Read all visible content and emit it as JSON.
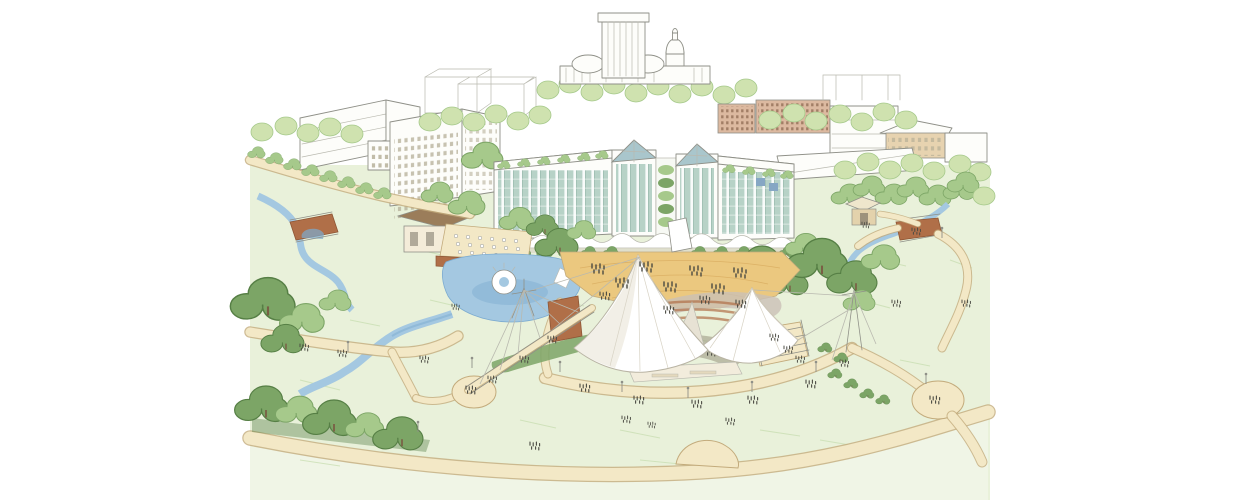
{
  "canvas": {
    "width": "1235",
    "height": "500",
    "viewbox": "0 0 1235 500",
    "background": "#ffffff"
  },
  "palette": {
    "background": "#ffffff",
    "line-gray": "#8f9088",
    "line-soft": "#b9b9af",
    "building-white": "#fdfdfa",
    "building-shade": "#ebebe2",
    "window-tan": "#d9c189",
    "brick-light": "#dcb9a0",
    "glass-teal": "#b7d2c7",
    "glass-deep": "#8fb3a6",
    "glass-blue": "#a9c6cc",
    "tree-light": "#cfe2af",
    "tree-mid": "#a6c98b",
    "tree-dark": "#7ca566",
    "tree-deep": "#567f45",
    "lawn": "#e9f1da",
    "lawn-pale": "#f0f5e6",
    "lawn-stroke": "#c6dcae",
    "path": "#f3e8c6",
    "path-edge": "#c3ab7c",
    "plaza": "#ebc87f",
    "plaza-line": "#d8ab5f",
    "paving-gray": "#cbc0b6",
    "water": "#a4c8e1",
    "water-deep": "#7cabd0",
    "brick": "#b06f48",
    "brick-dark": "#8e5635",
    "roof-brown": "#9b7d5a",
    "canopy": "#ffffff",
    "canopy-shade": "#e7e2d4",
    "stage-dark": "#98917e",
    "figure": "#4b4b43"
  },
  "scene": {
    "elements": [
      "city-skyline",
      "capitol-tower",
      "old-capitol-dome",
      "office-buildings",
      "residential-building",
      "glass-condo-wings",
      "glass-atrium-towers",
      "roof-gardens",
      "arcade-canopy",
      "event-plaza",
      "waterfall-sculpture",
      "fountain-pond",
      "terrace-pavilion",
      "amphitheater-canopy",
      "stage",
      "cable-masts",
      "pedestrian-bridge",
      "brick-bridges",
      "streams",
      "gazebo",
      "lawns",
      "walking-paths",
      "overlook-plazas",
      "trees",
      "hedges",
      "people",
      "lampposts"
    ]
  }
}
